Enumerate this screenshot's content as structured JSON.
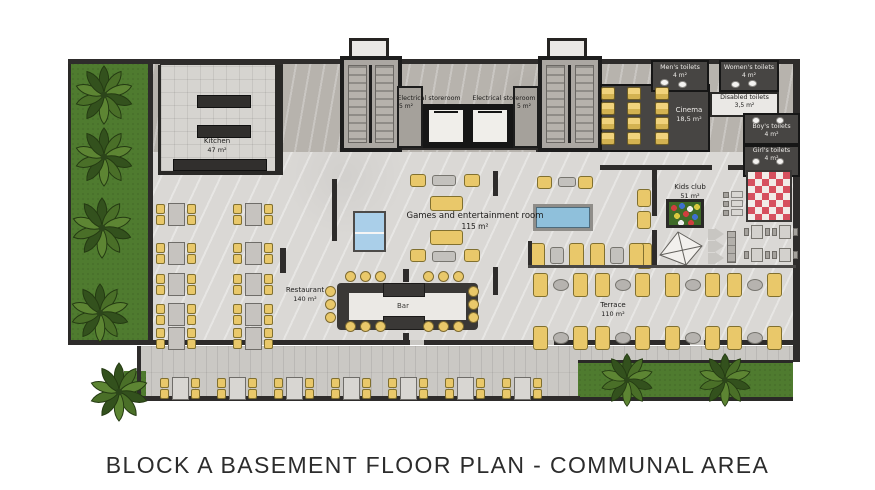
{
  "title": "BLOCK A BASEMENT FLOOR PLAN - COMMUNAL AREA",
  "rooms": {
    "kitchen": {
      "name": "Kitchen",
      "area": "47 m²"
    },
    "electrical_storeroom_1": {
      "name": "Electrical storeroom",
      "area": "5 m²"
    },
    "electrical_storeroom_2": {
      "name": "Electrical storeroom",
      "area": "5 m²"
    },
    "cinema": {
      "name": "Cinema",
      "area": "18,5 m²"
    },
    "mens_toilets": {
      "name": "Men's toilets",
      "area": "4 m²"
    },
    "womens_toilets": {
      "name": "Women's toilets",
      "area": "4 m²"
    },
    "disabled_toilets": {
      "name": "Disabled toilets",
      "area": "3,5 m²"
    },
    "boys_toilets": {
      "name": "Boy's toilets",
      "area": "4 m²"
    },
    "girls_toilets": {
      "name": "Girl's toilets",
      "area": "4 m²"
    },
    "kids_club": {
      "name": "Kids club",
      "area": "51 m²"
    },
    "games_room": {
      "name": "Games and entertainment room",
      "area": "115 m²"
    },
    "restaurant": {
      "name": "Restaurant",
      "area": "140 m²"
    },
    "bar": {
      "name": "Bar"
    },
    "terrace": {
      "name": "Terrace",
      "area": "110 m²"
    }
  },
  "colors": {
    "grass": "#4f7b2f",
    "wall": "#2e2c2b",
    "furniture_yellow": "#e9c86a",
    "pool_table_blue": "#8fc0db",
    "ping_pong_blue": "#aacfe9",
    "kids_mat_red": "#d6505e",
    "marble_light": "#dad8d5",
    "marble_dark": "#b7b3ad"
  }
}
